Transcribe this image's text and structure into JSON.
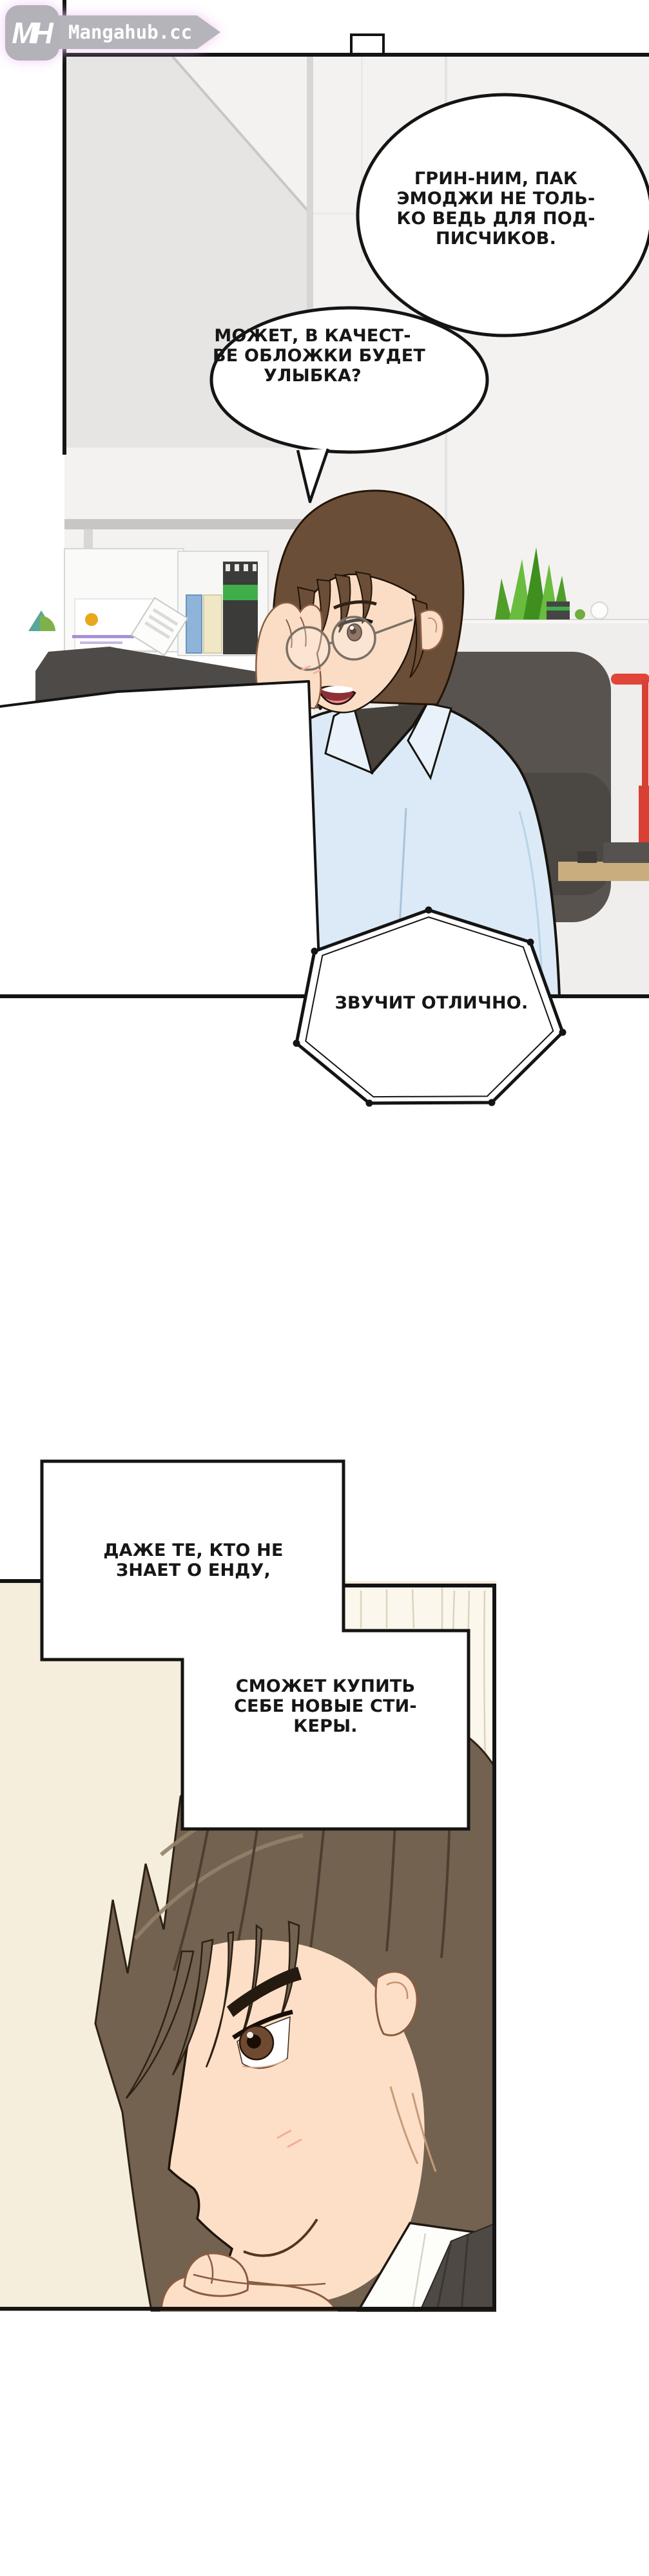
{
  "site": {
    "logo_monogram": "MH",
    "logo_text": "Mangahub.cc"
  },
  "panel1": {
    "bubble_grin": {
      "lines": [
        "ГРИН-НИМ, ПАК",
        "ЭМОДЖИ НЕ ТОЛЬ-",
        "КО ВЕДЬ ДЛЯ ПОД-",
        "ПИСЧИКОВ."
      ]
    },
    "bubble_cover": {
      "lines": [
        "МОЖЕТ, В КАЧЕСТ-",
        "ВЕ ОБЛОЖКИ БУДЕТ",
        "УЛЫБКА?"
      ]
    },
    "bubble_sounds": {
      "lines": [
        "ЗВУЧИТ ОТЛИЧНО."
      ]
    }
  },
  "panel2": {
    "bubble_even": {
      "lines": [
        "ДАЖЕ ТЕ, КТО НЕ",
        "ЗНАЕТ О ЕНДУ,"
      ]
    },
    "bubble_buy": {
      "lines": [
        "СМОЖЕТ КУПИТЬ",
        "СЕБЕ НОВЫЕ СТИ-",
        "КЕРЫ."
      ]
    }
  },
  "colors": {
    "ink": "#141414",
    "logo_gray": "#b5b4ba",
    "logo_glow": "#f2c6fa",
    "office_wall": "#f3f2f0",
    "gray_wall": "#e6e5e3",
    "binder_green": "#3fae4a",
    "lamp_red": "#df4335",
    "plant_green": "#5aa832",
    "shirt_blue": "#dbeaf6",
    "turtleneck": "#47423b",
    "hair_brown_1": "#6b4e38",
    "hair_brown_2": "#73624f",
    "skin": "#fcdfc6",
    "cream_wall": "#f5eedd"
  }
}
